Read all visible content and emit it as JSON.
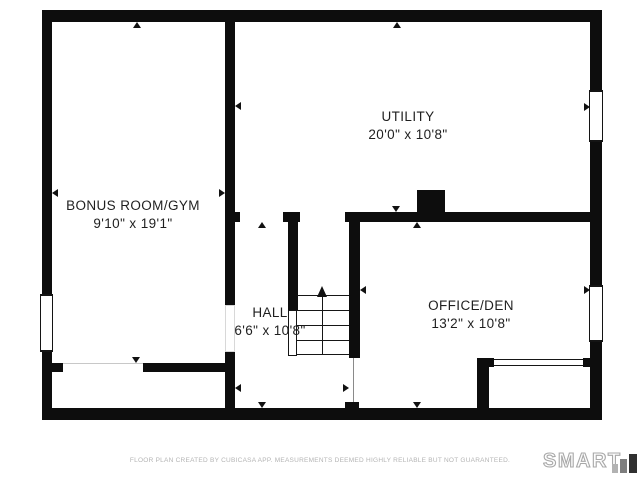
{
  "colors": {
    "wall": "#0d0d0d",
    "label_text": "#1f1f1f",
    "stair_line": "#161616",
    "footer_text": "#b4b4b4",
    "logo_outline": "#a8a8a8"
  },
  "plan": {
    "rooms": [
      {
        "name": "BONUS ROOM/GYM",
        "dims": "9'10\" x 19'1\"",
        "cx": 133,
        "cy": 215
      },
      {
        "name": "UTILITY",
        "dims": "20'0\" x 10'8\"",
        "cx": 408,
        "cy": 126
      },
      {
        "name": "HALL",
        "dims": "6'6\" x 10'8\"",
        "cx": 270,
        "cy": 322
      },
      {
        "name": "OFFICE/DEN",
        "dims": "13'2\" x 10'8\"",
        "cx": 471,
        "cy": 315
      }
    ],
    "walls": [
      {
        "x": 42,
        "y": 10,
        "w": 560,
        "h": 12
      },
      {
        "x": 42,
        "y": 408,
        "w": 560,
        "h": 12
      },
      {
        "x": 42,
        "y": 10,
        "w": 10,
        "h": 284
      },
      {
        "x": 42,
        "y": 352,
        "w": 10,
        "h": 68
      },
      {
        "x": 590,
        "y": 10,
        "w": 12,
        "h": 80
      },
      {
        "x": 590,
        "y": 142,
        "w": 12,
        "h": 143
      },
      {
        "x": 590,
        "y": 342,
        "w": 12,
        "h": 78
      },
      {
        "x": 225,
        "y": 22,
        "w": 10,
        "h": 283
      },
      {
        "x": 225,
        "y": 352,
        "w": 10,
        "h": 56
      },
      {
        "x": 52,
        "y": 363,
        "w": 11,
        "h": 9
      },
      {
        "x": 143,
        "y": 363,
        "w": 82,
        "h": 9
      },
      {
        "x": 225,
        "y": 212,
        "w": 15,
        "h": 10
      },
      {
        "x": 283,
        "y": 212,
        "w": 17,
        "h": 10
      },
      {
        "x": 345,
        "y": 212,
        "w": 245,
        "h": 10
      },
      {
        "x": 288,
        "y": 222,
        "w": 10,
        "h": 88
      },
      {
        "x": 349,
        "y": 222,
        "w": 11,
        "h": 136
      },
      {
        "x": 417,
        "y": 190,
        "w": 28,
        "h": 26
      },
      {
        "x": 477,
        "y": 358,
        "w": 12,
        "h": 50
      },
      {
        "x": 477,
        "y": 358,
        "w": 17,
        "h": 9
      },
      {
        "x": 583,
        "y": 358,
        "w": 7,
        "h": 9
      },
      {
        "x": 345,
        "y": 402,
        "w": 14,
        "h": 8
      }
    ],
    "windows": [
      {
        "x": 40,
        "y": 294,
        "w": 13,
        "h": 58
      },
      {
        "x": 589,
        "y": 90,
        "w": 14,
        "h": 52
      },
      {
        "x": 589,
        "y": 285,
        "w": 14,
        "h": 57
      }
    ],
    "lines": [
      {
        "x": 297,
        "y": 295,
        "w": 52,
        "h": 1,
        "c": "#161616"
      },
      {
        "x": 297,
        "y": 310,
        "w": 52,
        "h": 1,
        "c": "#161616"
      },
      {
        "x": 297,
        "y": 325,
        "w": 52,
        "h": 1,
        "c": "#161616"
      },
      {
        "x": 297,
        "y": 340,
        "w": 52,
        "h": 1,
        "c": "#161616"
      },
      {
        "x": 297,
        "y": 354,
        "w": 52,
        "h": 1,
        "c": "#161616"
      },
      {
        "x": 322,
        "y": 296,
        "w": 1,
        "h": 58,
        "c": "#161616"
      },
      {
        "x": 353,
        "y": 358,
        "w": 1,
        "h": 44,
        "c": "#8a8a8a"
      },
      {
        "x": 63,
        "y": 363,
        "w": 80,
        "h": 1,
        "c": "#c8c8c8"
      },
      {
        "x": 494,
        "y": 359,
        "w": 89,
        "h": 1,
        "c": "#161616"
      },
      {
        "x": 494,
        "y": 365,
        "w": 89,
        "h": 1,
        "c": "#161616"
      }
    ],
    "outlines": [
      {
        "x": 288,
        "y": 310,
        "w": 9,
        "h": 46,
        "c": "#161616",
        "name": "stair-stringer"
      },
      {
        "x": 225,
        "y": 305,
        "w": 10,
        "h": 47,
        "c": "#d8d8d8",
        "name": "opening-jamb"
      }
    ],
    "markers": [
      {
        "dir": "up",
        "x": 137,
        "y": 22
      },
      {
        "dir": "up",
        "x": 397,
        "y": 22
      },
      {
        "dir": "up",
        "x": 262,
        "y": 222
      },
      {
        "dir": "up",
        "x": 417,
        "y": 222
      },
      {
        "dir": "down",
        "x": 136,
        "y": 363
      },
      {
        "dir": "down",
        "x": 396,
        "y": 212
      },
      {
        "dir": "down",
        "x": 262,
        "y": 408
      },
      {
        "dir": "down",
        "x": 417,
        "y": 408
      },
      {
        "dir": "left",
        "x": 52,
        "y": 193
      },
      {
        "dir": "left",
        "x": 235,
        "y": 106
      },
      {
        "dir": "left",
        "x": 235,
        "y": 388
      },
      {
        "dir": "left",
        "x": 360,
        "y": 290
      },
      {
        "dir": "right",
        "x": 225,
        "y": 193
      },
      {
        "dir": "right",
        "x": 590,
        "y": 107
      },
      {
        "dir": "right",
        "x": 349,
        "y": 388
      },
      {
        "dir": "right",
        "x": 590,
        "y": 290
      },
      {
        "dir": "up",
        "x": 322,
        "y": 286,
        "size": "large"
      }
    ]
  },
  "footer": {
    "disclaimer": "FLOOR PLAN CREATED BY CUBICASA APP. MEASUREMENTS DEEMED HIGHLY RELIABLE BUT NOT GUARANTEED."
  },
  "logo": {
    "text": "SMART",
    "bars": [
      {
        "x": 612,
        "y": 464,
        "w": 6,
        "h": 9,
        "c": "#b2b2b2"
      },
      {
        "x": 620,
        "y": 459,
        "w": 7,
        "h": 14,
        "c": "#7e7e7e"
      },
      {
        "x": 629,
        "y": 454,
        "w": 8,
        "h": 19,
        "c": "#303030"
      }
    ]
  }
}
